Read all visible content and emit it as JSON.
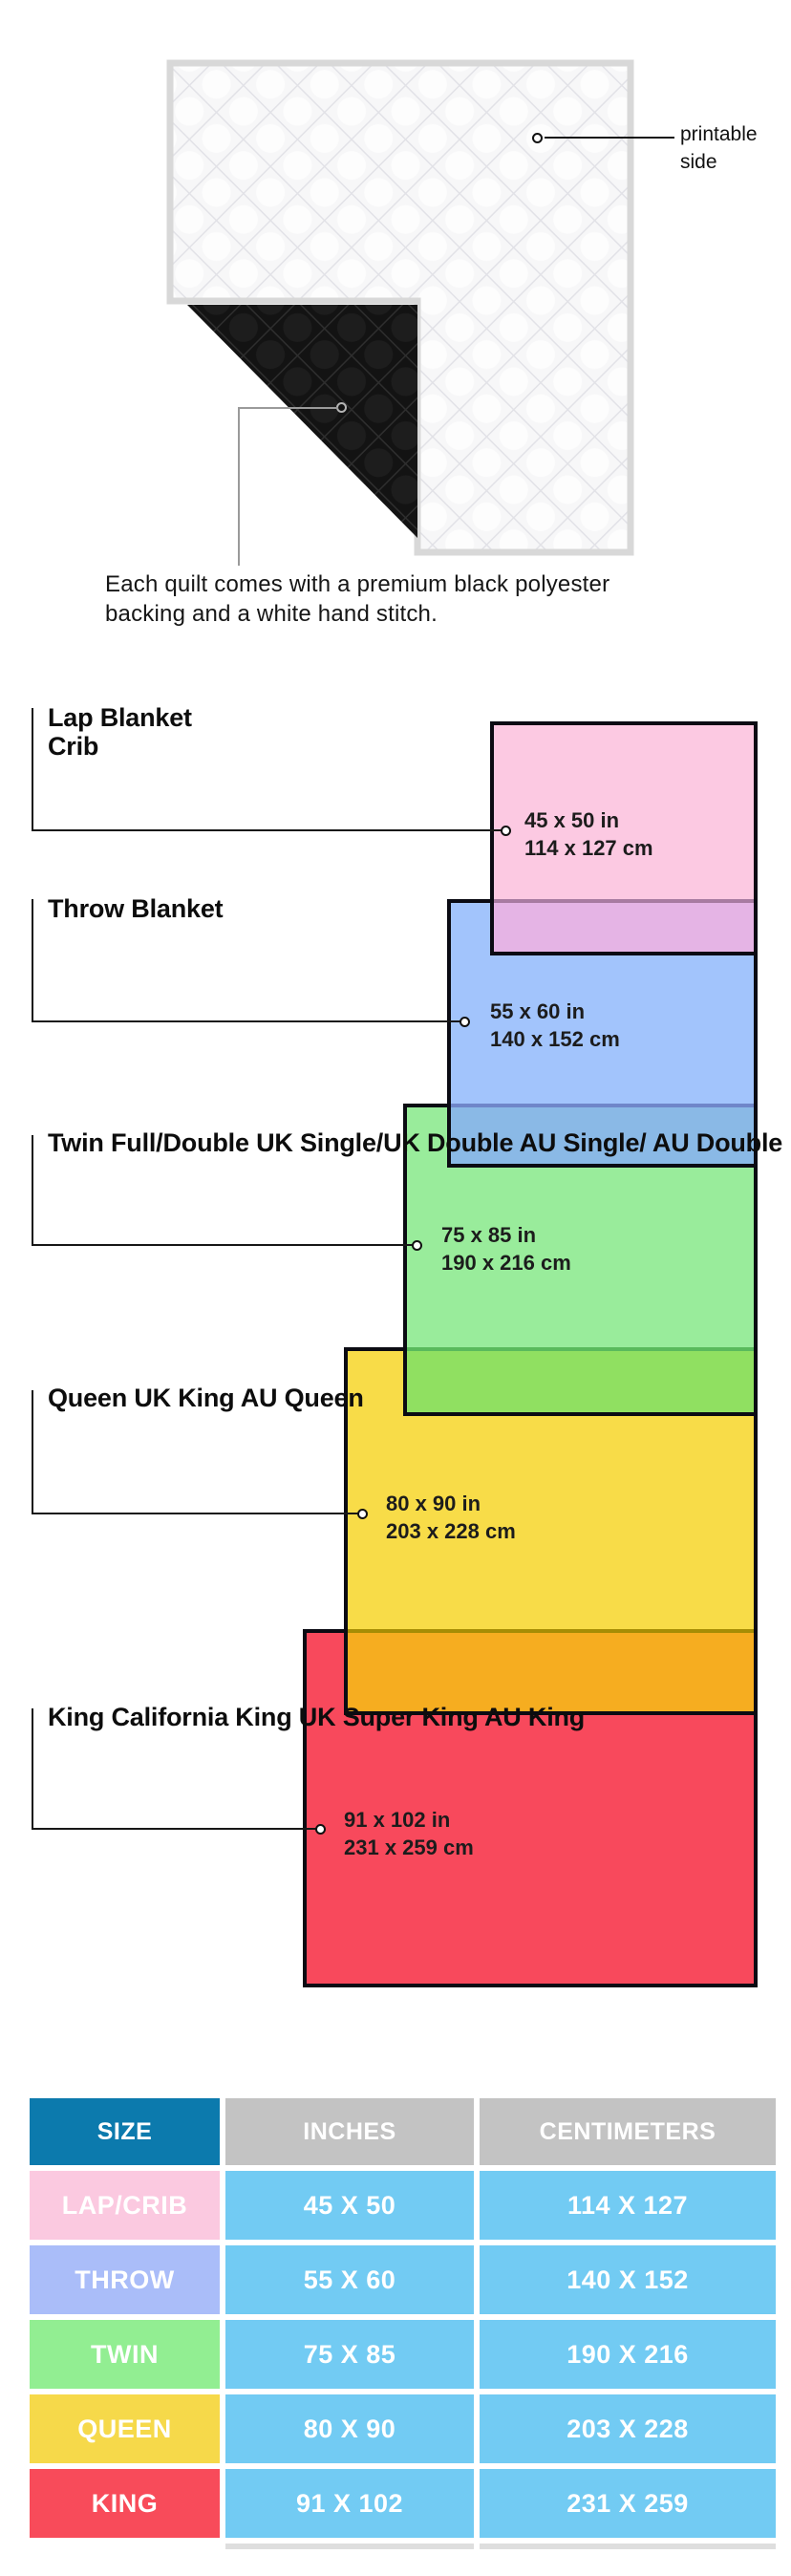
{
  "quilt_note": {
    "printable_label": "printable\nside",
    "caption": "Each quilt comes with a premium black polyester\nbacking and a white hand stitch."
  },
  "sizes": [
    {
      "name": "lap-crib",
      "labels": "Lap Blanket\nCrib",
      "dims": "45 x 50 in\n114 x 127 cm",
      "fill": "#fcc9e2"
    },
    {
      "name": "throw",
      "labels": "Throw Blanket",
      "dims": "55 x 60 in\n140 x 152 cm",
      "fill": "#a2c4fc"
    },
    {
      "name": "twin",
      "labels": "Twin\nFull/Double\nUK Single/UK Double\nAU Single/ AU Double",
      "dims": "75 x 85 in\n190 x 216 cm",
      "fill": "#99ec9b"
    },
    {
      "name": "queen",
      "labels": "Queen\nUK King\nAU Queen",
      "dims": "80 x 90 in\n203 x 228 cm",
      "fill": "#f8dc48"
    },
    {
      "name": "king",
      "labels": "King\nCalifornia King\nUK Super King\nAU King",
      "dims": "91 x 102 in\n231 x 259 cm",
      "fill": "#f8495c"
    }
  ],
  "overlap_colors": {
    "pink_over_blue": "#e5b4e5",
    "blue_over_green": "#8ab9e6",
    "green_over_yellow": "#90e061",
    "yellow_over_red": "#f6ad20"
  },
  "table": {
    "headers": [
      "SIZE",
      "INCHES",
      "CENTIMETERS"
    ],
    "header_bg_size": "#0c7aad",
    "header_bg_other": "#c3c3c3",
    "data_cell_bg": "#72cbf3",
    "rows": [
      [
        "LAP/CRIB",
        "45 X 50",
        "114 X 127"
      ],
      [
        "THROW",
        "55 X 60",
        "140 X 152"
      ],
      [
        "TWIN",
        "75 X 85",
        "190 X 216"
      ],
      [
        "QUEEN",
        "80 X 90",
        "203 X 228"
      ],
      [
        "KING",
        "91 X 102",
        "231 X 259"
      ]
    ],
    "row_label_bg": [
      "#fbc9e0",
      "#aabdf9",
      "#92ee92",
      "#f6d94a",
      "#f84b5a"
    ]
  }
}
